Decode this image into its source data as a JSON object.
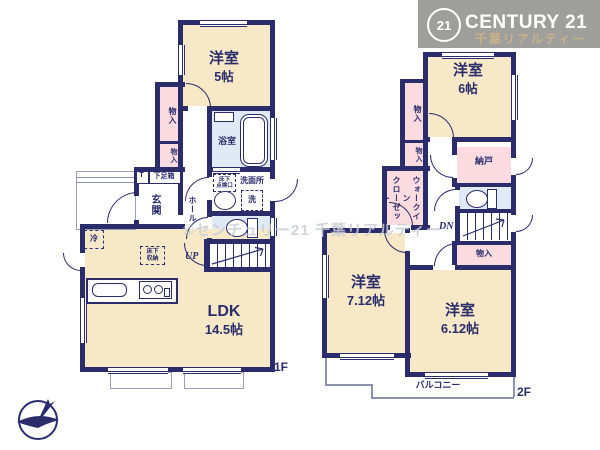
{
  "brand": {
    "badge": "21",
    "name": "CENTURY 21",
    "subtitle": "千葉リアルティー",
    "band_color": "#97979a",
    "subtitle_color": "#c9b389"
  },
  "watermark": "©センチュリー21 千葉リアルティー",
  "colors": {
    "wall_navy": "#2b2d6b",
    "room_cream": "#f7e9c7",
    "closet_pink": "#fadce0",
    "wet_area_blue": "#dfeaf6"
  },
  "floor1": {
    "floor_label": "1F",
    "western_room": {
      "name": "洋室",
      "size": "5帖"
    },
    "ldk": {
      "name": "LDK",
      "size": "14.5帖"
    },
    "closet_upper": "物入",
    "closet_lower": "物入",
    "bathroom": "浴室",
    "entrance": "玄関",
    "hall": "ホール",
    "washroom": "洗面所",
    "washer": "洗",
    "shoe_box_t": "T",
    "shoe_box": "下足箱",
    "underfloor_hatch": [
      "床下",
      "点検口"
    ],
    "underfloor_storage": [
      "床下",
      "収納"
    ],
    "fridge": "冷",
    "stairs": "UP"
  },
  "floor2": {
    "floor_label": "2F",
    "western_room_6": {
      "name": "洋室",
      "size": "6帖"
    },
    "western_room_712": {
      "name": "洋室",
      "size": "7.12帖"
    },
    "western_room_612": {
      "name": "洋室",
      "size": "6.12帖"
    },
    "closet_upper": "物入",
    "closet_lower": "物入",
    "closet_hall": "物入",
    "walk_in_closet": "ウォークイン\nクローゼット",
    "storeroom": "納戸",
    "balcony": "バルコニー",
    "stairs": "DN"
  }
}
